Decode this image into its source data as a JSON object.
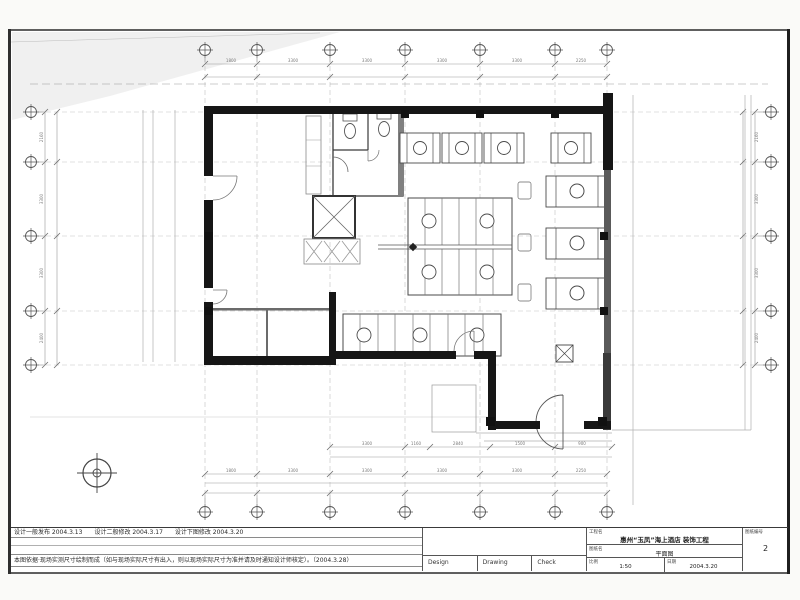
{
  "notes": {
    "row1": "设计一般发布 2004.3.13　　设计二般修改 2004.3.17　　设计下图修改 2004.3.20",
    "row4": "本图依据·现场实测尺寸绘制而成（如与现场实际尺寸有出入，则以现场实际尺寸为准并请及时通知设计师核定）。（2004.3.28）"
  },
  "signoff": {
    "design": "Design",
    "drawing": "Drawing",
    "check": "Check"
  },
  "titleblock": {
    "project_label": "工程名",
    "project_value": "惠州“玉凤”海上酒店 装饰工程",
    "drawing_label": "图纸名",
    "drawing_value": "平面图",
    "scale_label": "比例",
    "scale_value": "1:50",
    "date_label": "日期",
    "date_value": "2004.3.20",
    "sheet_label": "图纸编号",
    "sheet_value": "2"
  },
  "dims": {
    "top": [
      "1800",
      "3300",
      "3300",
      "3300",
      "3300",
      "2250"
    ],
    "bottom": [
      "1800",
      "3300",
      "3300",
      "3300",
      "3300",
      "2250"
    ],
    "left": [
      "2160",
      "3300",
      "3300",
      "2400"
    ],
    "right": [
      "2160",
      "3300",
      "3300",
      "2400"
    ],
    "inner": [
      "3300",
      "1160",
      "2840",
      "1500",
      "900"
    ]
  },
  "colors": {
    "wall": "#161616",
    "line": "#555555",
    "grid": "#bdbdbd",
    "paper": "#ffffff"
  }
}
